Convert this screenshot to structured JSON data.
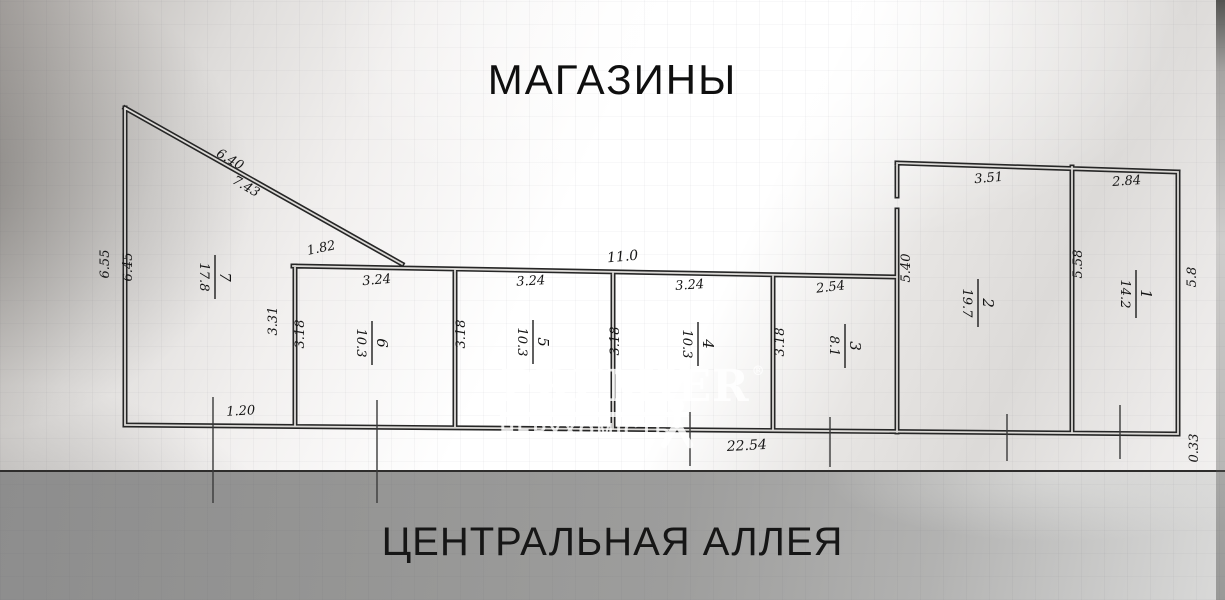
{
  "header": {
    "title": "МАГАЗИНЫ"
  },
  "footer": {
    "title": "ЦЕНТРАЛЬНАЯ АЛЛЕЯ"
  },
  "watermark": {
    "brand": "PREMIER",
    "registered": "®",
    "subtitle": "НЕРУХОМІСТЬ"
  },
  "colors": {
    "ink": "#262626",
    "watermark": "#ffffff",
    "band_gray": "#9a9a9a"
  },
  "plan": {
    "rooms": {
      "r1": {
        "num": "1",
        "area": "14.2"
      },
      "r2": {
        "num": "2",
        "area": "19.7"
      },
      "r3": {
        "num": "3",
        "area": "8.1"
      },
      "r4": {
        "num": "4",
        "area": "10.3"
      },
      "r5": {
        "num": "5",
        "area": "10.3"
      },
      "r6": {
        "num": "6",
        "area": "10.3"
      },
      "r7": {
        "num": "7",
        "area": "17.8"
      }
    },
    "dims": {
      "diag_upper": "6.40",
      "diag_lower": "7.43",
      "left_outer": "6.55",
      "left_inner": "6.45",
      "wall_seg": "1.82",
      "room6_width": "3.24",
      "room5_width": "3.24",
      "room4_width": "3.24",
      "room3_width": "2.54",
      "room7_depth": "3.31",
      "room6_depth": "3.18",
      "room5_depth": "3.18",
      "room4_depth": "3.18",
      "room3_depth": "3.18",
      "corridor_length": "11.0",
      "room2_left": "5.40",
      "room2_width": "3.51",
      "room1_width": "2.84",
      "room1_left": "5.58",
      "room1_right": "5.8",
      "bottom_left": "1.20",
      "bottom_total": "22.54",
      "bottom_right": "0.33"
    }
  }
}
